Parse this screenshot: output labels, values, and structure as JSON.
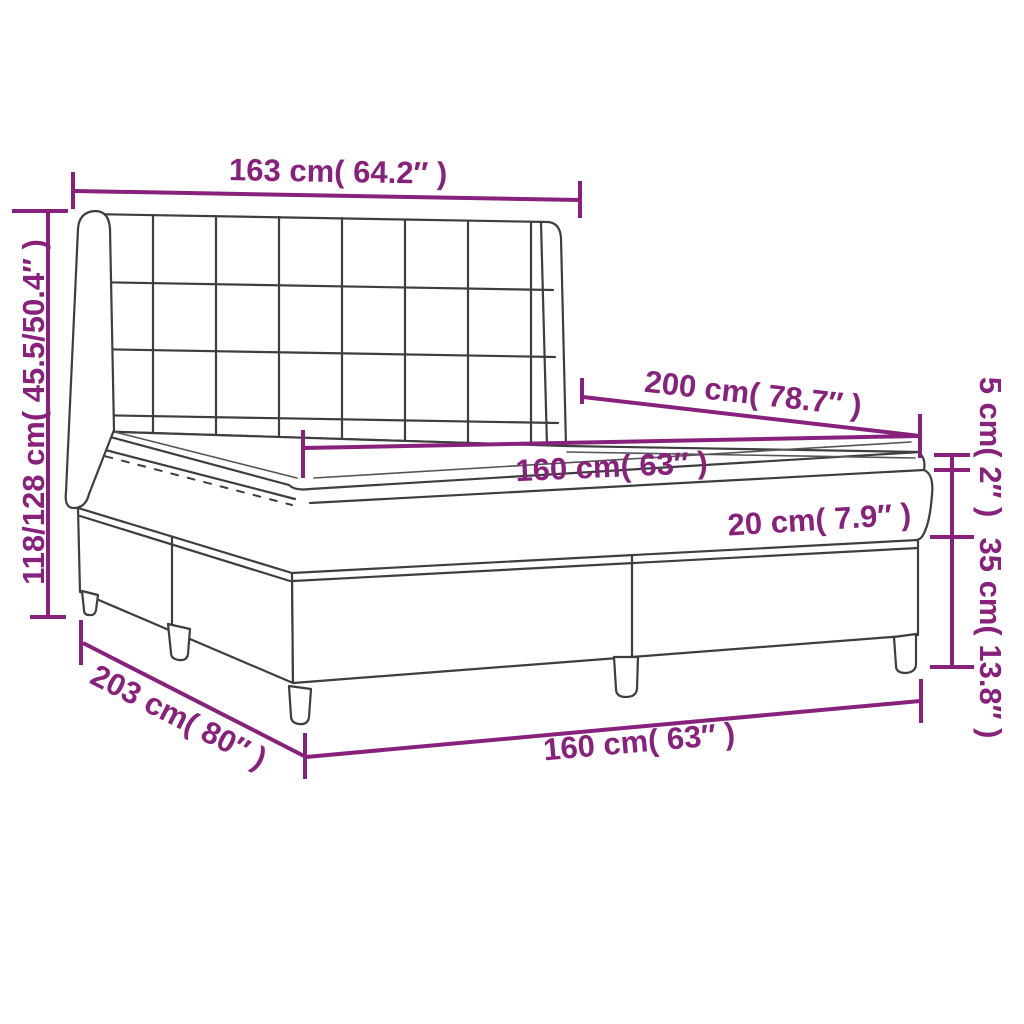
{
  "figure": {
    "subject": "box spring bed with tufted wingback headboard, mattress and topper",
    "style": "line-art dimension diagram",
    "colors": {
      "background": "#FFFFFF",
      "line_art": "#3E3E3E",
      "dimension_accent": "#87217B"
    },
    "labels": {
      "headboard_width": "163 cm( 64.2″ )",
      "headboard_height": "118/128 cm( 45.5/50.4″ )",
      "mattress_length": "200 cm( 78.7″ )",
      "mattress_width": "160 cm( 63″ )",
      "mattress_height": "20 cm( 7.9″ )",
      "topper_height": "5 cm( 2″ )",
      "base_height": "35 cm( 13.8″ )",
      "bed_length": "203 cm( 80″ )",
      "base_width": "160 cm( 63″ )"
    }
  }
}
